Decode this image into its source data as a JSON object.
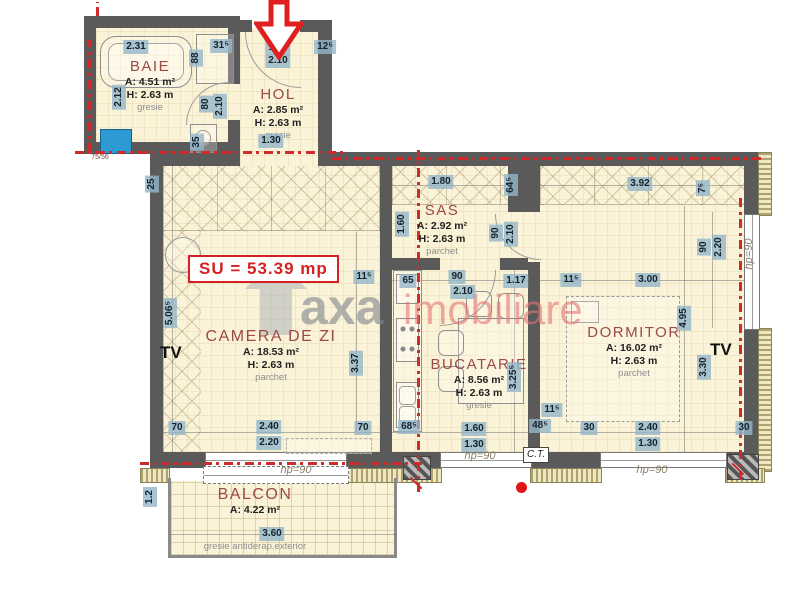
{
  "su_label": "SU = 53.39 mp",
  "watermark": {
    "gray": "axa",
    "red": "imobiliare"
  },
  "labels": {
    "tv_left": "TV",
    "tv_right": "TV"
  },
  "rooms": {
    "baie": {
      "name": "BAIE",
      "area": "A: 4.51 m²",
      "height": "H: 2.63 m",
      "floor": "gresie"
    },
    "hol": {
      "name": "HOL",
      "area": "A: 2.85 m²",
      "height": "H: 2.63 m",
      "floor": "gresie"
    },
    "sas": {
      "name": "SAS",
      "area": "A: 2.92 m²",
      "height": "H: 2.63 m",
      "floor": "parchet"
    },
    "camera": {
      "name": "CAMERA DE ZI",
      "area": "A: 18.53 m²",
      "height": "H: 2.63 m",
      "floor": "parchet"
    },
    "bucatarie": {
      "name": "BUCATARIE",
      "area": "A: 8.56 m²",
      "height": "H: 2.63 m",
      "floor": "gresie"
    },
    "dormitor": {
      "name": "DORMITOR",
      "area": "A: 16.02 m²",
      "height": "H: 2.63 m",
      "floor": "parchet"
    },
    "balcon": {
      "name": "BALCON",
      "area": "A: 4.22 m²",
      "floor": "gresie antiderap.exterior"
    }
  },
  "dimensions": [
    {
      "t": "2.31",
      "x": 136,
      "y": 47
    },
    {
      "t": "31⁵",
      "x": 221,
      "y": 46
    },
    {
      "t": "88",
      "x": 196,
      "y": 58,
      "v": 1
    },
    {
      "t": "2.12",
      "x": 119,
      "y": 97,
      "v": 1
    },
    {
      "t": "80",
      "x": 206,
      "y": 104,
      "v": 1
    },
    {
      "t": "2.10",
      "x": 220,
      "y": 106,
      "v": 1
    },
    {
      "t": "35",
      "x": 197,
      "y": 142,
      "v": 1
    },
    {
      "t": "1.00",
      "x": 278,
      "y": 48
    },
    {
      "t": "2.10",
      "x": 278,
      "y": 61
    },
    {
      "t": "12⁵",
      "x": 325,
      "y": 47
    },
    {
      "t": "1.30",
      "x": 271,
      "y": 141
    },
    {
      "t": "25",
      "x": 152,
      "y": 184,
      "v": 1
    },
    {
      "t": "75/56",
      "x": 100,
      "y": 158,
      "kind": "plain"
    },
    {
      "t": "1.80",
      "x": 441,
      "y": 182
    },
    {
      "t": "64⁵",
      "x": 511,
      "y": 185,
      "v": 1
    },
    {
      "t": "1.60",
      "x": 402,
      "y": 224,
      "v": 1
    },
    {
      "t": "3.92",
      "x": 640,
      "y": 184
    },
    {
      "t": "7⁵",
      "x": 703,
      "y": 188,
      "v": 1
    },
    {
      "t": "90",
      "x": 496,
      "y": 233,
      "v": 1
    },
    {
      "t": "2.10",
      "x": 511,
      "y": 234,
      "v": 1
    },
    {
      "t": "90",
      "x": 704,
      "y": 247,
      "v": 1
    },
    {
      "t": "2.20",
      "x": 719,
      "y": 247,
      "v": 1
    },
    {
      "t": "hp=90",
      "x": 749,
      "y": 254,
      "v": 1,
      "kind": "hp"
    },
    {
      "t": "5.06⁵",
      "x": 170,
      "y": 313,
      "v": 1
    },
    {
      "t": "11⁵",
      "x": 364,
      "y": 277
    },
    {
      "t": "65",
      "x": 408,
      "y": 281
    },
    {
      "t": "90",
      "x": 457,
      "y": 277
    },
    {
      "t": "2.10",
      "x": 463,
      "y": 292
    },
    {
      "t": "1.17",
      "x": 516,
      "y": 281
    },
    {
      "t": "11⁵",
      "x": 571,
      "y": 280
    },
    {
      "t": "3.00",
      "x": 648,
      "y": 280
    },
    {
      "t": "3.37",
      "x": 356,
      "y": 363,
      "v": 1
    },
    {
      "t": "4.95",
      "x": 684,
      "y": 318,
      "v": 1
    },
    {
      "t": "3.30",
      "x": 704,
      "y": 367,
      "v": 1
    },
    {
      "t": "3.25⁵",
      "x": 514,
      "y": 377,
      "v": 1
    },
    {
      "t": "11⁵",
      "x": 552,
      "y": 410
    },
    {
      "t": "70",
      "x": 177,
      "y": 428
    },
    {
      "t": "2.40",
      "x": 269,
      "y": 427
    },
    {
      "t": "2.20",
      "x": 269,
      "y": 443
    },
    {
      "t": "70",
      "x": 363,
      "y": 428
    },
    {
      "t": "68⁵",
      "x": 409,
      "y": 427
    },
    {
      "t": "1.60",
      "x": 474,
      "y": 429
    },
    {
      "t": "1.30",
      "x": 474,
      "y": 445
    },
    {
      "t": "48⁵",
      "x": 540,
      "y": 426
    },
    {
      "t": "C.T.",
      "x": 536,
      "y": 455,
      "kind": "box"
    },
    {
      "t": "30",
      "x": 589,
      "y": 428
    },
    {
      "t": "2.40",
      "x": 648,
      "y": 428
    },
    {
      "t": "1.30",
      "x": 648,
      "y": 444
    },
    {
      "t": "30",
      "x": 744,
      "y": 428
    },
    {
      "t": "hp=90",
      "x": 296,
      "y": 470,
      "kind": "hp"
    },
    {
      "t": "hp=90",
      "x": 480,
      "y": 456,
      "kind": "hp"
    },
    {
      "t": "hp=90",
      "x": 652,
      "y": 470,
      "kind": "hp"
    },
    {
      "t": "1.2",
      "x": 150,
      "y": 497,
      "v": 1
    },
    {
      "t": "3.60",
      "x": 272,
      "y": 534
    }
  ]
}
